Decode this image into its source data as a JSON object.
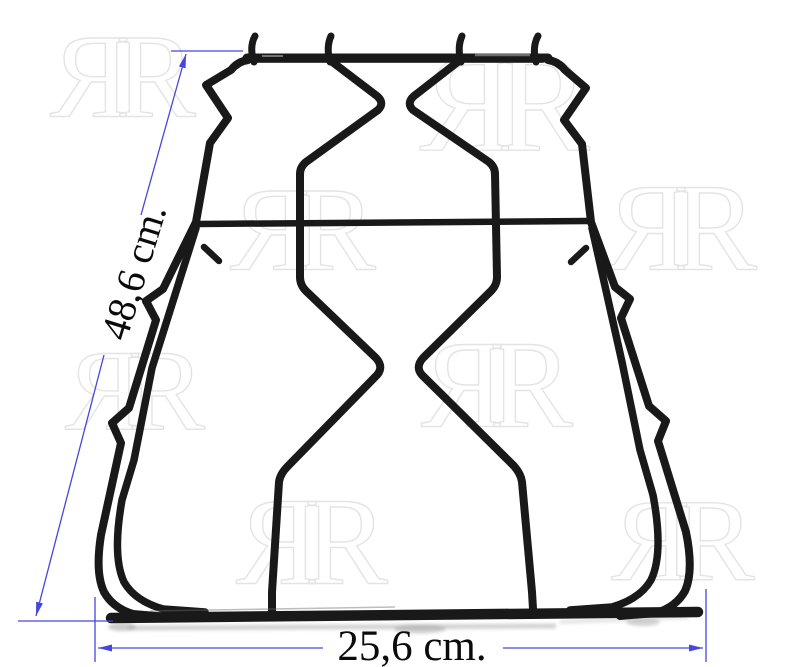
{
  "page": {
    "width": 800,
    "height": 667,
    "background": "#ffffff"
  },
  "subject": {
    "name": "pan-support-grid"
  },
  "grid": {
    "wire_color": "#191919"
  },
  "annotations": {
    "color": "#4646dd",
    "text_color": "#0b0b0b",
    "height_label": "48,6 cm.",
    "width_label": "25,6 cm."
  },
  "watermark": {
    "text": "ЯR",
    "letter": "R",
    "outline_color": "#e4e4e4",
    "instances": [
      {
        "x": 123,
        "y": 77,
        "size": 120
      },
      {
        "x": 505,
        "y": 104,
        "size": 140
      },
      {
        "x": 303,
        "y": 230,
        "size": 120
      },
      {
        "x": 681,
        "y": 228,
        "size": 125
      },
      {
        "x": 497,
        "y": 385,
        "size": 125
      },
      {
        "x": 312,
        "y": 542,
        "size": 125
      },
      {
        "x": 683,
        "y": 541,
        "size": 118
      },
      {
        "x": 135,
        "y": 391,
        "size": 115
      }
    ]
  }
}
